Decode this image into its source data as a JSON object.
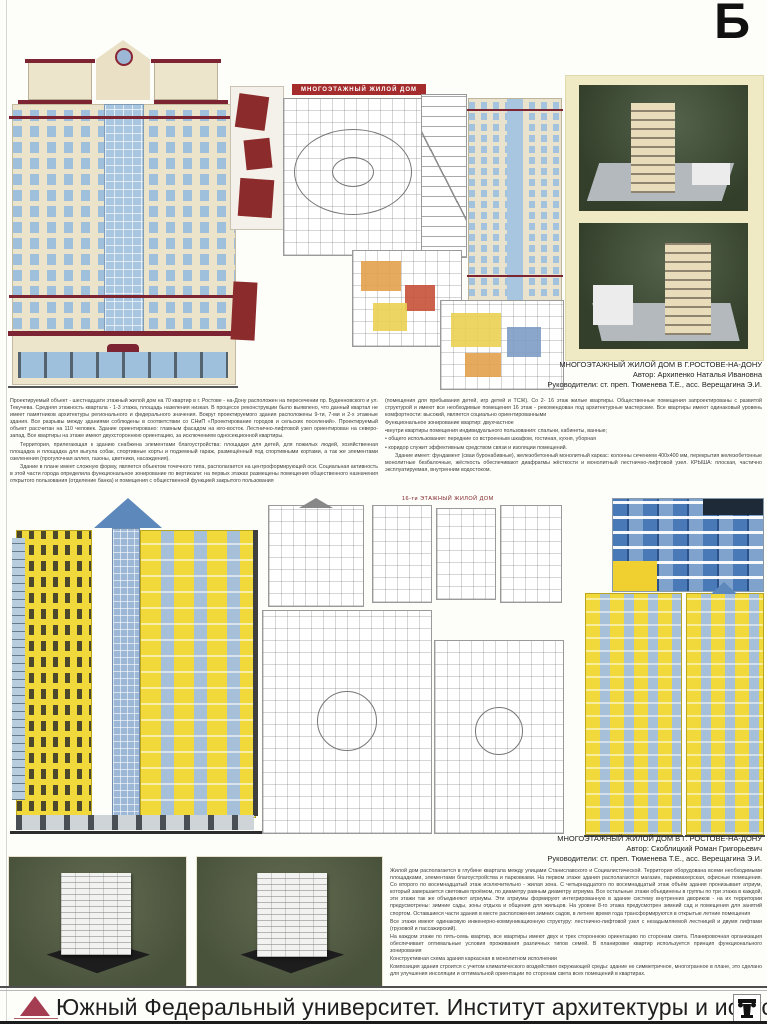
{
  "corner_letter": "Б",
  "project1": {
    "plans_header": "МНОГОЭТАЖНЫЙ  ЖИЛОЙ  ДОМ",
    "caption": {
      "title": "МНОГОЭТАЖНЫЙ ЖИЛОЙ ДОМ В Г.РОСТОВЕ-НА-ДОНУ",
      "author": "Автор:  Архипенко Наталья Ивановна",
      "supervisors": "Руководители: ст. преп.  Тюменева Т.Е., асс. Верещагина Э.И."
    },
    "description": {
      "col1_p1": "Проектируемый объект - шестнадцати этажный жилой дом на 70 квартир в г. Ростове - на-Дону расположен на пересечении  пр. Буденновского и ул. Текучева.  Средняя этажность квартала - 1-3 этажа, площадь назеления низкая. В процессе реконструкции было выявлено, что данный квартал не имеет памятников архитектуры регионального и федерального значения.  Вокруг проектируемого здания расположены 9-ти, 7-ми и 2-х этажные здания. Все разрывы между зданиями соблюдены в соответствии со СНиП «Проектирование городов и сельских поселений». Проектируемый объект рассчитан на 110 человек. Здание ориентировано: главным фасадом на юго-восток. Лестнично-лифтовой узел ориентирован на северо-запад. Все квартиры на этаже имеют двухстороннюю ориентацию, за исключением односекционной квартиры.",
      "col1_p2": "Территория, прилегающая к зданию снабжена элементами благоустройства: площадки для детей, для пожилых людей, хозяйственная площадка и площадка для выгула собак, спортивные корты и подземный гараж, размещённый под спортивными кортами, а так же элементами озеленения (прогулочная аллея, газоны, цветники, насаждения).",
      "col1_p3": "Здание в плане имеет сложную форму, является объектом точечного типа,  располагается на центроформирующей оси. Социальная активность в этой части города определила функциональное зонирование по вертикали: на первых этажах размещены помещения общественного назначения открытого пользования (отделение банка) и помещения с общественной функцией закрытого пользования",
      "col2_p1": "(помещения для пребывания детей, игр детей и ТСЖ). Со 2- 16 этаж жилые квартиры. Общественные помещения запроектированы с развитой структурой и имеют все необходимые помещения 16 этаж - рекомендован под архитектурные мастерские. Все квартиры имеют одинаковый уровень комфортности: высокий, является социально ориентированными",
      "col2_p2": "Функциональное зонирование квартир:  двухчастное",
      "col2_b1": "•внутри квартиры помещения индивидуального пользования: спальни, кабинеты, ванные;",
      "col2_b2": "•  общего использования: передние со встроенным шкафом, гостиная, кухня, уборная",
      "col2_b3": "•  коридор служит эффективным средством связи и изоляции помещений.",
      "col2_p3": "Здание имеет:  фундамент (сваи буронабивные), железобетонный монолитный каркас: колонны сечением 400х400 мм, перекрытия железобетонные монолитные безбалочные, жёсткость обеспечивают диафрагмы жёсткости и монолитный лестнично-лифтовой узел. КРЫША: плоская, частично эксплуатируемая, внутренним водостоком."
    }
  },
  "project2": {
    "plans_header": "16-ти ЭТАЖНЫЙ ЖИЛОЙ ДОМ",
    "caption": {
      "title": "МНОГОЭТАЖНЫЙ ЖИЛОЙ ДОМ В  Г. РОСТОВЕ-НА-ДОНУ",
      "author": "Автор: Скоблицкий Роман Григорьевич",
      "supervisors": "Руководители: ст. преп.  Тюменева Т.Е., асс. Верещагина Э.И."
    },
    "description": {
      "p1": "Жилой дом располагается в глубине квартала между улицами Станиславского и Социалистической.  Территория оборудована  всеми необходимыми  площадками, элементами благоустройства и парковками. На первом этаже здания располагаются магазин, парикмахерская, офисные помещения.  Со второго по восемнадцатый этаж исключительно - жилая зона. С четырнадцатого по восемнадцатый этаж объём здания пронизывает атриум, который завершается световым проёмом, по диаметру равным диаметру атриума.  Все остальные этажи объединены в группы по три этажа в каждой, эти этажи так же объединяют атриумы.  Эти атриумы формируют интегрированную в здание систему внутренних двориков - на их территории предусмотрены: зимние сады, зоны отдыха и общения для жильцов. На уровне 8-го этажа предусмотрен зимний сад и помещения для занятий спортом.  Оставшиеся части здания в месте расположения зимних садов, в летнее время года трансформируются в открытые летние помещения",
      "p2": "Все этажи имеют одинаковую инженерно-коммуникационную структуру:  лестнично-лифтовой узел с незадымляемой лестницей и двумя лифтами (грузовой и пассажирский).",
      "p3": "На каждом этаже по пять-семь квартир,  все квартиры имеют двух и трех стороннюю ориентацию по сторонам света.  Планировочная организация обеспечивает оптимальные условия проживания различных типов семей. В планировке квартир используется принцип функционального зонирования",
      "p4": "Конструктивная схема здания каркасная в монолитном исполнении",
      "p5": "Композиция здания строится с учетом климатического воздействия окружающей среды: здание не симметричное,  многогранное в плане, это сделано для улучшения инсоляции и оптимальной ориентации по сторонам света всех помещений в квартирах."
    }
  },
  "footer": {
    "text": "Южный Федеральный университет. Институт архитектуры и искусств"
  }
}
